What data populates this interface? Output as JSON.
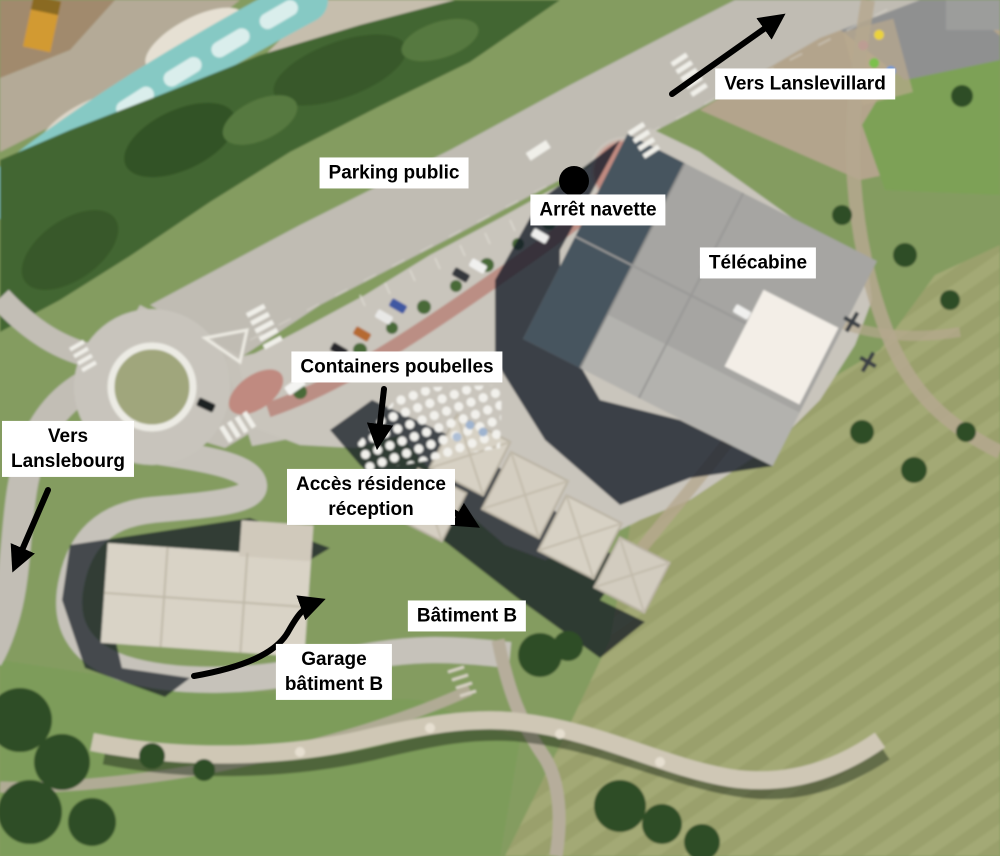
{
  "scene": {
    "type": "annotated-aerial-photo",
    "background_color": "#849c60",
    "annotation_style": {
      "label_background": "#ffffff",
      "label_text_color": "#000000",
      "arrow_color": "#000000",
      "dot_color": "#000000"
    }
  },
  "labels": {
    "vers_lanslevillard": {
      "text": "Vers Lanslevillard"
    },
    "parking_public": {
      "text": "Parking public"
    },
    "arret_navette": {
      "text": "Arrêt navette"
    },
    "telecabine": {
      "text": "Télécabine"
    },
    "containers_poubelles": {
      "text": "Containers poubelles"
    },
    "acces_residence": {
      "line1": "Accès résidence",
      "line2": "réception"
    },
    "batiment_b": {
      "text": "Bâtiment B"
    },
    "garage_batiment_b": {
      "line1": "Garage",
      "line2": "bâtiment B"
    },
    "vers_lanslebourg": {
      "line1": "Vers",
      "line2": "Lanslebourg"
    }
  },
  "markers": {
    "arret_navette_dot": {
      "shape": "filled-circle",
      "color": "#000000"
    }
  },
  "arrows": {
    "vers_lanslevillard": {
      "style": "straight",
      "direction": "up-right"
    },
    "vers_lanslebourg": {
      "style": "straight",
      "direction": "down-left"
    },
    "containers_poubelles": {
      "style": "straight",
      "direction": "down"
    },
    "acces_residence": {
      "style": "straight",
      "direction": "down-right"
    },
    "garage_batiment_b": {
      "style": "curved",
      "direction": "right"
    }
  }
}
